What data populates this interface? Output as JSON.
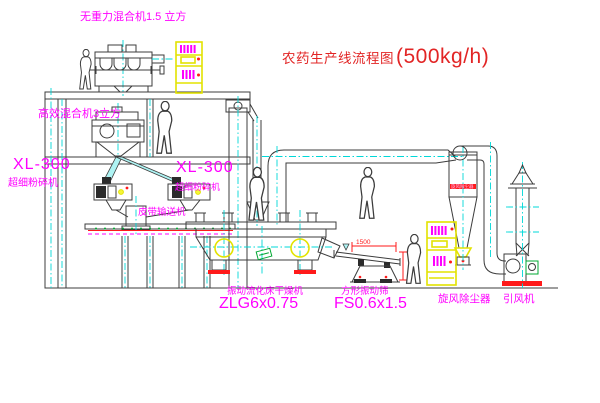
{
  "title": {
    "name": "农药生产线流程图",
    "capacity": "(500kg/h)"
  },
  "labels": {
    "gravity_mixer": "无重力混合机1.5 立方",
    "high_eff_mixer": "高效混合机3立方",
    "mill_left_model": "XL-300",
    "mill_left_name": "超细粉碎机",
    "mill_right_model": "XL-300",
    "mill_right_name": "超细粉碎机",
    "belt_conveyor": "皮带输送机",
    "dryer_name": "振动流化床干燥机",
    "dryer_model": "ZLG6x0.75",
    "sieve_name": "方形振动筛",
    "sieve_model": "FS0.6x1.5",
    "cyclone": "旋风除尘器",
    "cyclone_band": "旋风除尘器",
    "fan": "引风机",
    "dim_length": "1500"
  },
  "colors": {
    "bg": "#ffffff",
    "magenta": "#ff00ff",
    "red": "#e22525",
    "pure_red": "#ff1a1a",
    "line": "#3c3c3c",
    "cyan": "#00d8d8",
    "yellow": "#e3e300",
    "green": "#00a832"
  }
}
